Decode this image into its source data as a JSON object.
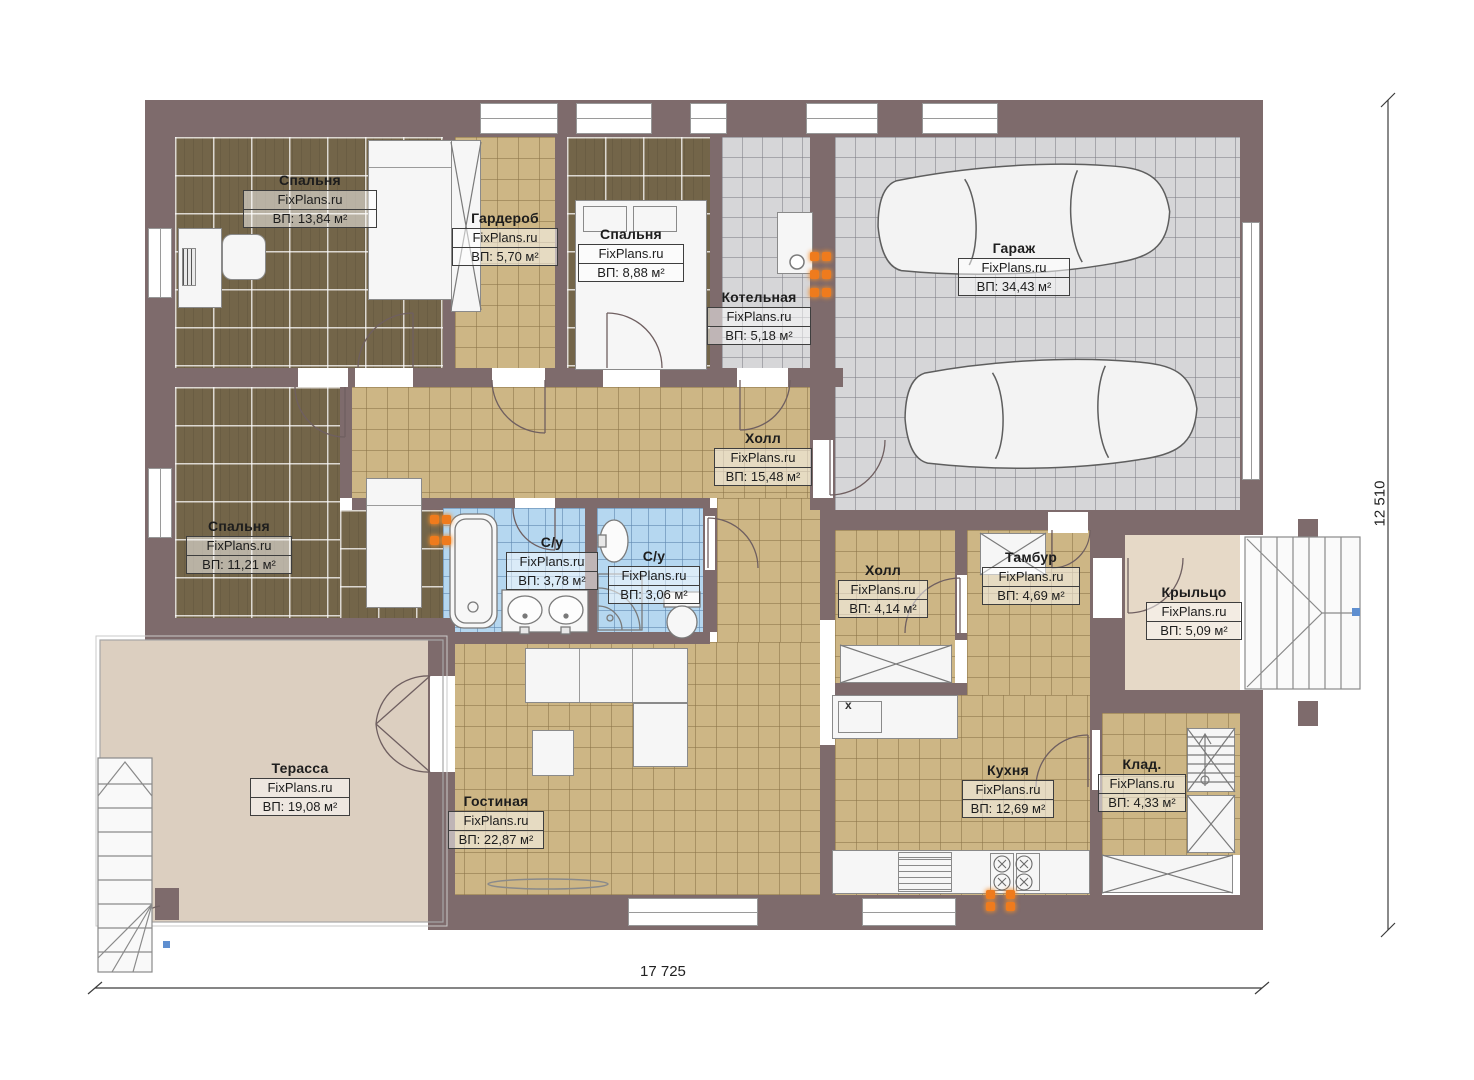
{
  "watermark": "FixPlans.ru",
  "rooms": [
    {
      "name": "Спальня",
      "area": "ВП: 13,84 м²"
    },
    {
      "name": "Гардероб",
      "area": "ВП: 5,70 м²"
    },
    {
      "name": "Спальня",
      "area": "ВП: 8,88 м²"
    },
    {
      "name": "Котельная",
      "area": "ВП: 5,18 м²"
    },
    {
      "name": "Гараж",
      "area": "ВП: 34,43 м²"
    },
    {
      "name": "Холл",
      "area": "ВП: 15,48 м²"
    },
    {
      "name": "Спальня",
      "area": "ВП: 11,21 м²"
    },
    {
      "name": "С/у",
      "area": "ВП: 3,78 м²"
    },
    {
      "name": "С/у",
      "area": "ВП: 3,06 м²"
    },
    {
      "name": "Холл",
      "area": "ВП: 4,14 м²"
    },
    {
      "name": "Тамбур",
      "area": "ВП: 4,69 м²"
    },
    {
      "name": "Крыльцо",
      "area": "ВП: 5,09 м²"
    },
    {
      "name": "Терасса",
      "area": "ВП: 19,08 м²"
    },
    {
      "name": "Гостиная",
      "area": "ВП: 22,87 м²"
    },
    {
      "name": "Кухня",
      "area": "ВП: 12,69 м²"
    },
    {
      "name": "Клад.",
      "area": "ВП: 4,33 м²"
    }
  ],
  "dimensions": {
    "width_label": "17 725",
    "height_label": "12 510"
  },
  "labels": {
    "sink_mark": "x"
  },
  "colors": {
    "wall": "#7e6b6c",
    "wood_floor": "#736549",
    "tile_tan": "#cdb685",
    "tile_gray": "#d6d6d8",
    "tile_blue": "#b5d7f0",
    "terrace": "#dccfc0",
    "porch": "#e6d9c7",
    "accent_orange": "#ef7b1d"
  }
}
